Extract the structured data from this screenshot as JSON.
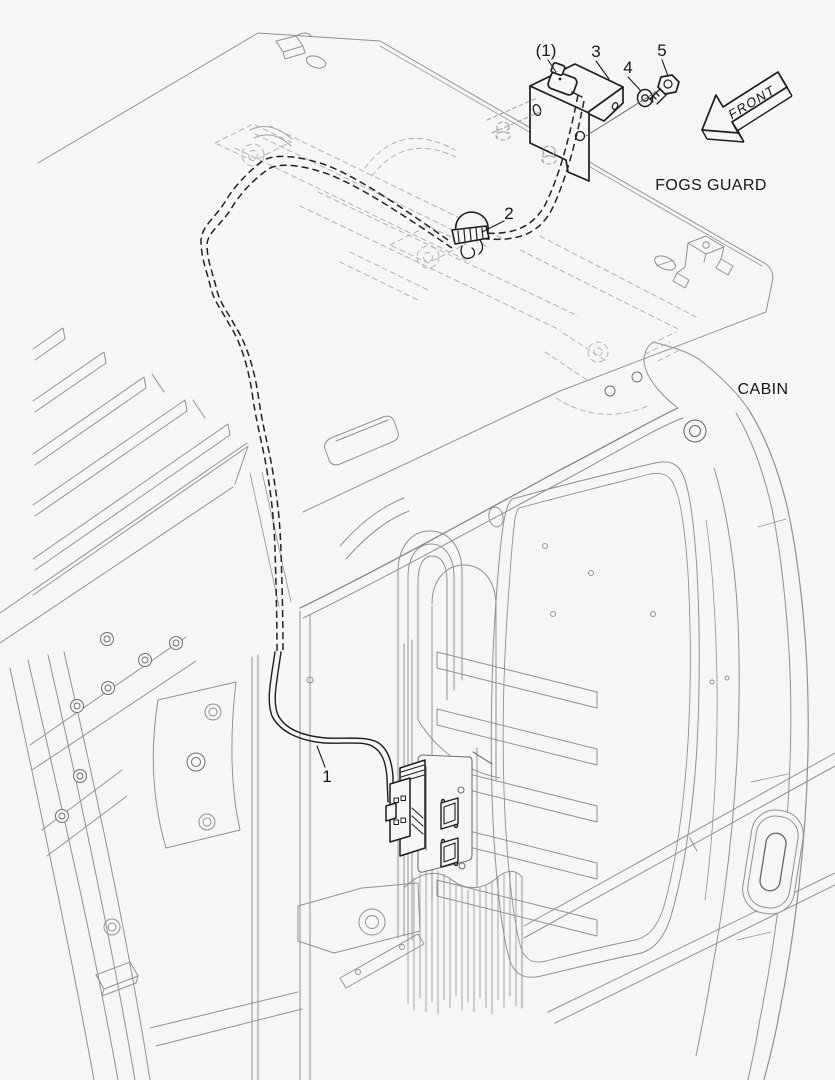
{
  "canvas": {
    "width": 835,
    "height": 1080,
    "background": "#f6f6f6"
  },
  "colors": {
    "ink": "#1d1d1d",
    "structure": "#8d9296",
    "ghost": "#b0b4b8"
  },
  "annotations": {
    "front": "FRONT",
    "fogs_guard": "FOGS GUARD",
    "cabin": "CABIN"
  },
  "callouts": {
    "antenna_ref": "(1)",
    "bracket": "3",
    "washer": "4",
    "bolt": "5",
    "antenna": "2",
    "cable": "1"
  }
}
